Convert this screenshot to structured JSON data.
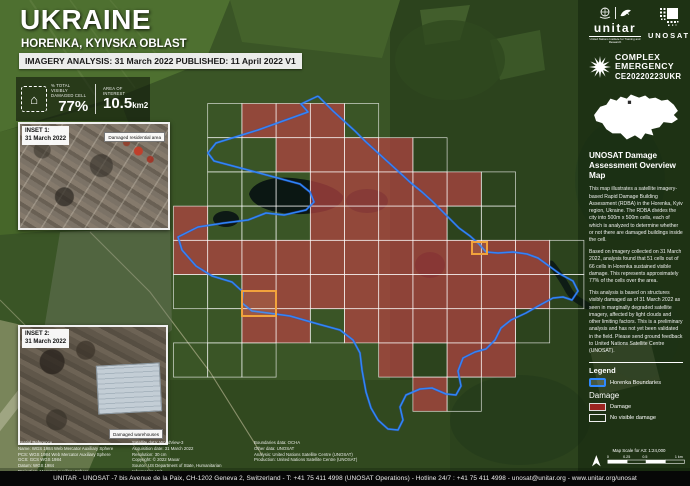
{
  "header": {
    "title": "UKRAINE",
    "subtitle": "HORENKA, KYIVSKA OBLAST",
    "analysis_line": "IMAGERY ANALYSIS: 31 March 2022 PUBLISHED: 11 April 2022 V1",
    "stats": {
      "damaged_label": "% TOTAL VISIBLY DAMAGED CELL",
      "damaged_value": "77%",
      "area_label": "AREA OF INTEREST",
      "area_value": "10.5",
      "area_unit": "km2"
    }
  },
  "insets": {
    "inset1": {
      "title": "INSET 1:\n31 March 2022",
      "annotation": "Damaged residential area"
    },
    "inset2": {
      "title": "INSET 2:\n31 March 2022",
      "annotation": "Damaged warehouses"
    }
  },
  "sidebar": {
    "logos": {
      "unitar": "unitar",
      "unitar_tagline": "United Nations Institute for Training and Research",
      "unosat": "UNOSAT"
    },
    "emergency": {
      "line1": "COMPLEX",
      "line2": "EMERGENCY",
      "code": "CE20220223UKR"
    },
    "heading": "UNOSAT Damage Assessment Overview Map",
    "paragraph1": "This map illustrates a satellite imagery-based Rapid Damage Building Assessment (RDBA) in the Horenka, Kyiv region, Ukraine. The RDBA divides the city into 500m x 500m cells, each of which is analyzed to determine whether or not there are damaged buildings inside the cell.",
    "paragraph2": "Based on imagery collected on 31 March 2022, analysis found that 51 cells out of 66 cells in Horenka sustained visible damage. This represents approximately 77% of the cells over the area.",
    "paragraph3": "This analysis is based on structures visibly damaged as of 31 March 2022 as seen in marginally degraded satellite imagery, affected by light clouds and other limiting factors. This is a preliminary analysis and has not yet been validated in the field. Please send ground feedback to United Nations Satellite Centre (UNOSAT).",
    "legend": {
      "title": "Legend",
      "boundary_label": "Horenka Boundaries",
      "damage_heading": "Damage",
      "damage_label": "Damage",
      "no_damage_label": "No visible damage"
    },
    "scale": {
      "text": "Map Scale for A3: 1:24,000",
      "ticks": [
        "0",
        "0.25",
        "0.5",
        "1 km"
      ]
    }
  },
  "map": {
    "grid": {
      "x0": 173.5,
      "y0": 103.5,
      "cell": 34.2,
      "rows": [
        ".NDDDN......",
        ".NNDDDDN....",
        ".NNNDDDDDN..",
        "DNNNDDDDNN..",
        "DDDDDDDDDDDN",
        "NNDDDDDDDDDN",
        ".NDDNDDDDDN.",
        "NNN...DNDD..",
        ".......DN..."
      ]
    },
    "colors": {
      "urban_underlay": "#8a7c68",
      "damage_fill": "#c1272d",
      "grid_stroke": "rgba(255,255,255,0.8)",
      "boundary": "#2f89ff",
      "boundary_casing": "#2b4fd0",
      "marker": "#f2a33c"
    },
    "boundary_points": "318,96 301,104 308,112 258,130 216,143 208,153 214,161 248,170 300,184 310,192 314,202 306,210 284,215 266,213 248,220 224,223 198,227 178,237 182,250 196,266 212,276 232,282 243,292 242,303 252,311 268,313 290,316 318,324 340,330 353,340 360,353 362,370 366,392 371,408 378,420 388,429 398,430 403,420 400,407 406,395 420,389 432,388 446,394 456,395 461,386 458,371 463,358 475,352 486,349 495,340 501,328 511,320 526,313 540,305 553,298 563,297 572,300 578,291 573,281 560,274 549,266 538,258 527,254 513,252 498,253 486,252 479,244 470,236 459,228 450,219 441,210 432,201 422,192 411,183 399,172 388,162 377,152 366,142 355,131 344,121 333,111 324,102 318,96",
    "markers": [
      {
        "x": 472,
        "y": 242,
        "w": 15,
        "h": 12
      },
      {
        "x": 242,
        "y": 291,
        "w": 34,
        "h": 25
      }
    ]
  },
  "footer": {
    "sources": {
      "col1": "Spatial Reference\nName: WGS 1984 Web Mercator Auxiliary Sphere\nPCS: WGS 1984 Web Mercator Auxiliary Sphere\nGCS: GCS WGS 1984\nDatum: WGS 1984\nProjection: Mercator Auxiliary Sphere",
      "col2": "Satellite data: WorldView-3\nAcquisition date: 31 March 2022\nResolution: 30 cm\nCopyright: © 2022 Maxar\nSource: US Department of State, Humanitarian Information Unit\nNextView License",
      "col3": "Boundaries data: OCHA\nOther data: UNOSAT\nAnalysis: United Nations Satellite Centre (UNOSAT)\nProduction: United Nations Satellite Centre (UNOSAT)"
    },
    "bar": "UNITAR - UNOSAT -7 bis Avenue de la Paix, CH-1202 Geneva 2, Switzerland - T: +41 75 411 4998 (UNOSAT Operations) - Hotline 24/7 : +41 75 411 4998 - unosat@unitar.org - www.unitar.org/unosat"
  }
}
